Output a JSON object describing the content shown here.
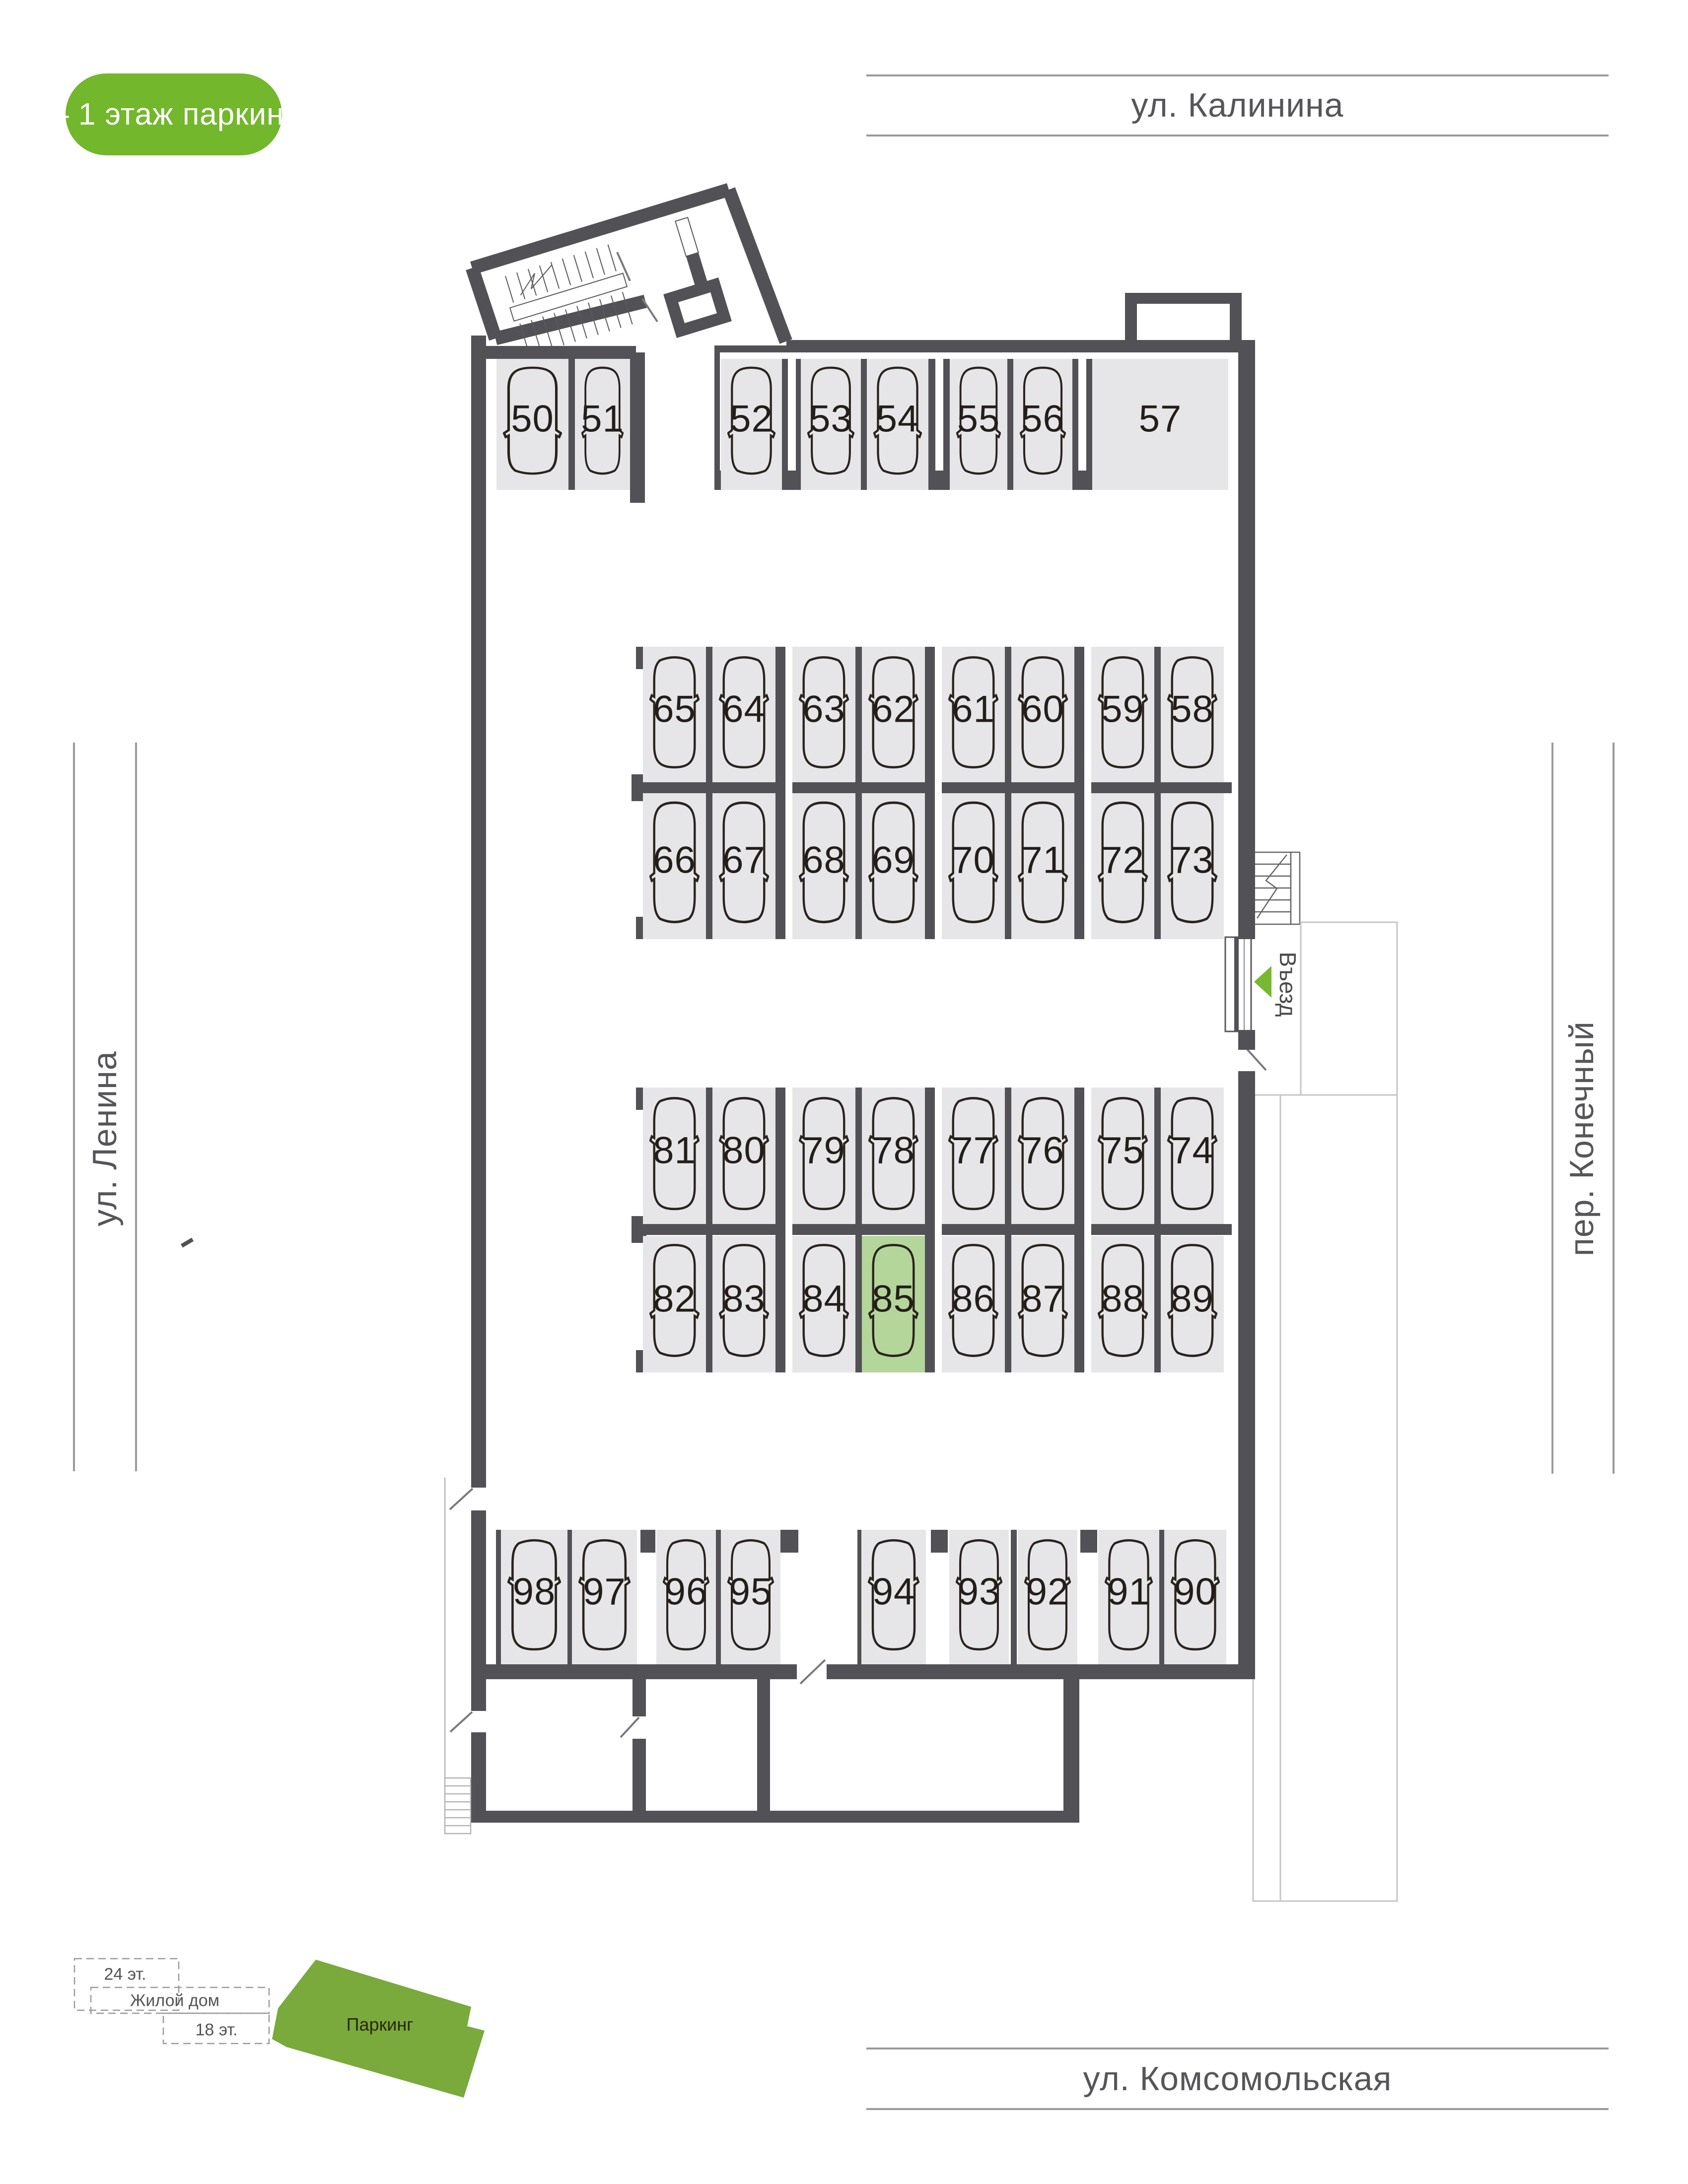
{
  "legend": {
    "label": "– 1 этаж паркинг"
  },
  "streets": {
    "top": "ул. Калинина",
    "bottom": "ул. Комсомольская",
    "left": "ул. Ленина",
    "right": "пер. Конечный"
  },
  "entrance": {
    "label": "Въезд"
  },
  "selected_spot": "85",
  "rows": [
    {
      "name": "row-top",
      "spots": [
        "50",
        "51",
        "52",
        "53",
        "54",
        "55",
        "56",
        "57"
      ]
    },
    {
      "name": "row-m1-upper",
      "spots": [
        "65",
        "64",
        "63",
        "62",
        "61",
        "60",
        "59",
        "58"
      ]
    },
    {
      "name": "row-m1-lower",
      "spots": [
        "66",
        "67",
        "68",
        "69",
        "70",
        "71",
        "72",
        "73"
      ]
    },
    {
      "name": "row-m2-upper",
      "spots": [
        "81",
        "80",
        "79",
        "78",
        "77",
        "76",
        "75",
        "74"
      ]
    },
    {
      "name": "row-m2-lower",
      "spots": [
        "82",
        "83",
        "84",
        "85",
        "86",
        "87",
        "88",
        "89"
      ]
    },
    {
      "name": "row-bottom-left",
      "spots": [
        "98",
        "97",
        "96",
        "95"
      ]
    },
    {
      "name": "row-bottom-right",
      "spots": [
        "94",
        "93",
        "92",
        "91",
        "90"
      ]
    }
  ],
  "minimap": {
    "label_24": "24 эт.",
    "label_house": "Жилой дом",
    "label_18": "18 эт.",
    "label_parking": "Паркинг"
  },
  "colors": {
    "wall": "#515156",
    "spot_fill": "#e6e6e8",
    "spot_selected": "#b5d69b",
    "badge_green": "#72b72c",
    "arrow_green": "#76b82f",
    "minimap_green": "#7aa93c"
  }
}
